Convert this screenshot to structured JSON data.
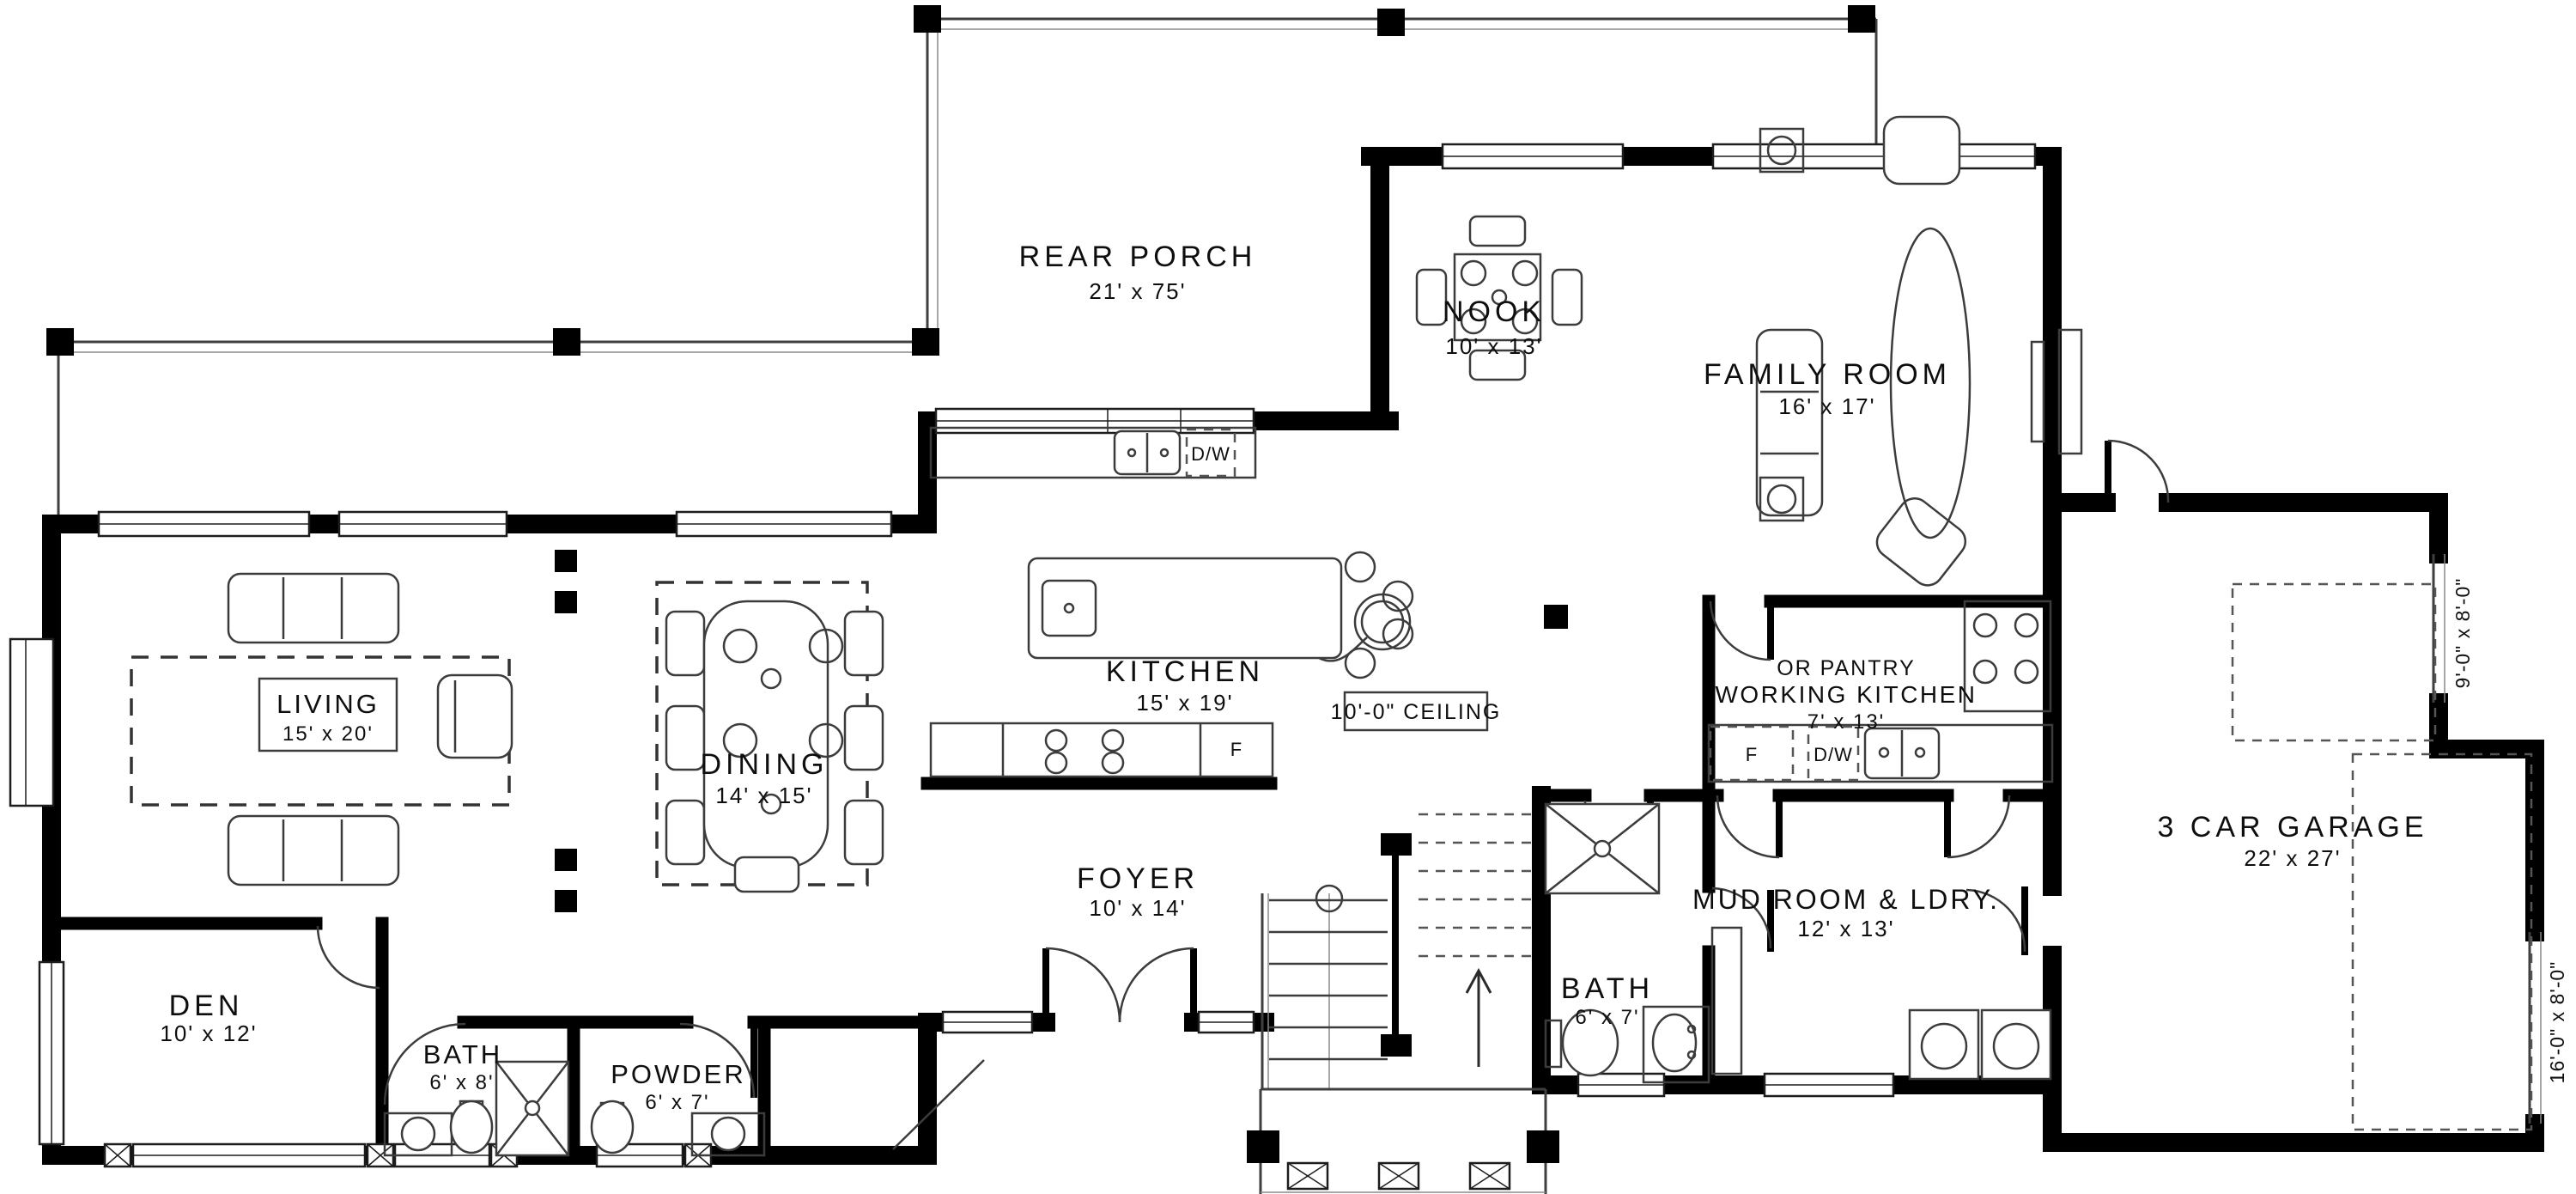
{
  "rooms": [
    {
      "name": "REAR PORCH",
      "dims": "21' x 75'"
    },
    {
      "name": "NOOK",
      "dims": "10' x 13'"
    },
    {
      "name": "FAMILY ROOM",
      "dims": "16' x 17'"
    },
    {
      "name": "LIVING",
      "dims": "15' x 20'"
    },
    {
      "name": "DINING",
      "dims": "14' x 15'"
    },
    {
      "name": "KITCHEN",
      "dims": "15' x 19'"
    },
    {
      "name": "WORKING KITCHEN",
      "dims": "7' x 13'",
      "note": "OR PANTRY"
    },
    {
      "name": "3 CAR GARAGE",
      "dims": "22' x 27'"
    },
    {
      "name": "FOYER",
      "dims": "10' x 14'"
    },
    {
      "name": "MUD ROOM & LDRY.",
      "dims": "12' x 13'"
    },
    {
      "name": "BATH",
      "dims": "6' x 7'"
    },
    {
      "name": "DEN",
      "dims": "10' x 12'"
    },
    {
      "name": "BATH",
      "dims": "6' x 8'"
    },
    {
      "name": "POWDER",
      "dims": "6' x 7'"
    }
  ],
  "annotations": {
    "ceiling_note": "10'-0\" CEILING",
    "garage_door_single": "9'-0\" x 8'-0\"",
    "garage_door_double": "16'-0\" x 8'-0\"",
    "dishwasher": "D/W",
    "fridge": "F"
  },
  "colors": {
    "wall": "#000000",
    "line": "#3c3c3c",
    "background": "#ffffff"
  }
}
